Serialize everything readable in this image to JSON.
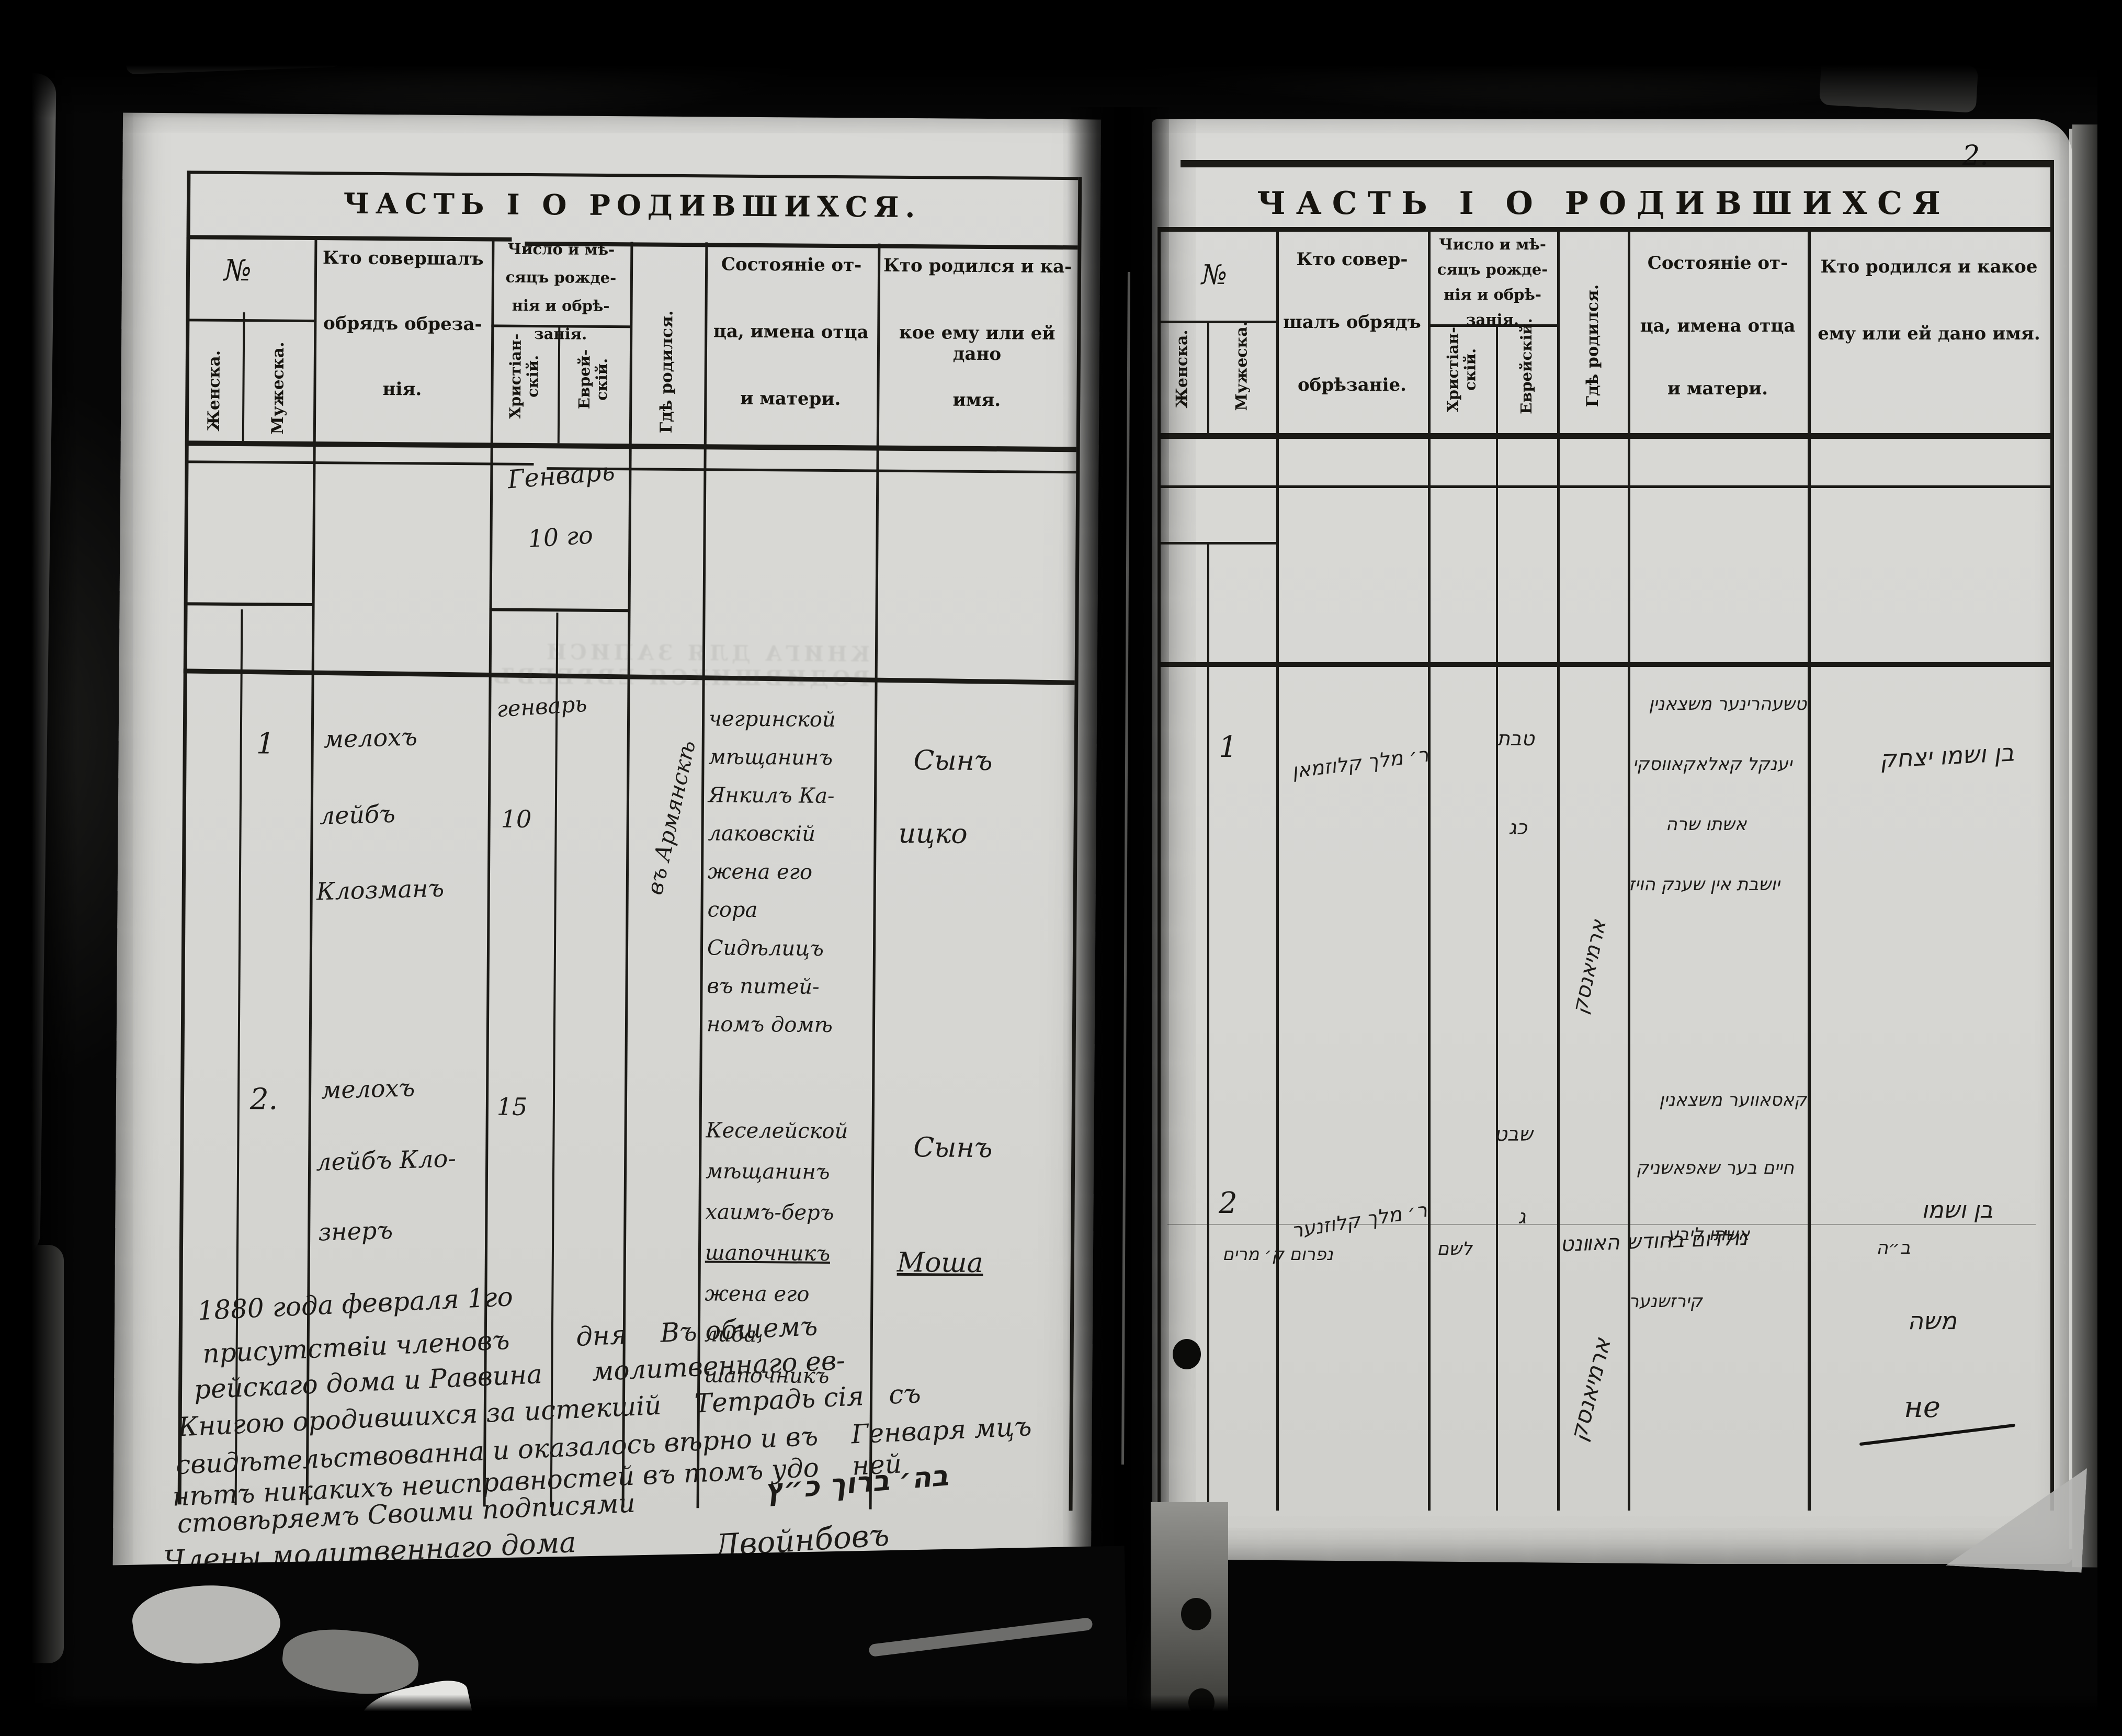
{
  "document": {
    "page_number": "2.",
    "colors": {
      "paper": "#d8d8d4",
      "ink": "#17150f",
      "backdrop": "#060606"
    },
    "left_page": {
      "title": "ЧАСТЬ I О РОДИВШИХСЯ.",
      "columns": {
        "no": "№",
        "female": "Женска.",
        "male": "Мужеска.",
        "performer_lines": [
          "Кто совершалъ",
          "обрядъ обреза-",
          "нія."
        ],
        "date_lines": [
          "Число и мѣ-",
          "сяцъ рожде-",
          "нія и обрѣ-",
          "занія."
        ],
        "christian": "Христіан- скій.",
        "jewish": "Еврей- скій.",
        "where_born": "Гдѣ родился.",
        "father_lines": [
          "Состояніе от-",
          "ца, имена отца",
          "и матери."
        ],
        "who_born_lines": [
          "Кто родился и ка-",
          "кое ему или ей дано",
          "имя."
        ]
      },
      "month_heading": "Генварь",
      "month_heading_day": "10 го",
      "ghost_stamp": "КНИГА ДЛЯ ЗАПИСИ РОДИВШИХСЯ ЕВРЕЕВЪ",
      "entries": [
        {
          "no": "1",
          "performer_lines": [
            "мелохъ",
            "лейбъ",
            "Клозманъ"
          ],
          "month": "генварь",
          "day": "10",
          "where_born": "въ Армянскѣ",
          "father_lines": [
            "чегринской",
            "мѣщанинъ",
            "Янкилъ Ка-",
            "лаковскій",
            "жена его",
            "сора",
            "Сидѣлицъ",
            "въ питей-",
            "номъ домѣ"
          ],
          "child": "Сынъ",
          "child_name": "ицко"
        },
        {
          "no": "2.",
          "performer_lines": [
            "мелохъ",
            "лейбъ Кло-",
            "знеръ"
          ],
          "day": "15",
          "father_lines": [
            "Кеселейской",
            "мѣщанинъ",
            "хаимъ-беръ",
            "шапочникъ",
            "жена его",
            "либа",
            "шапочникъ"
          ],
          "child": "Сынъ",
          "child_name": "Моша"
        }
      ],
      "certification_lines": [
        "1880 года февраля 1го",
        "присутствіи членовъ        дня    Въ общемъ",
        "рейскаго дома и Раввина      молитвеннаго ев-",
        "Книгою ородившихся за истекшій    Тетрадь сія   съ",
        "свидѣтельствованна и оказалось вѣрно и въ    Генваря мцъ",
        "нѣтъ никакихъ неисправностей въ томъ удо    ней",
        "стовѣряемъ Своими подписями",
        "Члены молитвеннаго дома"
      ],
      "signature_hebrew": "בה׳ ברוך כ״ץ",
      "signature_cyrillic": "Двойнбовъ"
    },
    "right_page": {
      "title": "ЧАСТЬ I О РОДИВШИХСЯ",
      "columns": {
        "no": "№",
        "female": "Женска.",
        "male": "Мужеска.",
        "performer_lines": [
          "Кто совер-",
          "шалъ обрядъ",
          "обрѣзаніе."
        ],
        "date_lines": [
          "Число и мѣ-",
          "сяцъ рожде-",
          "нія и обрѣ-",
          "занія."
        ],
        "christian": "Христіан- скій.",
        "jewish": "Еврейскій.",
        "where_born": "Гдѣ родился.",
        "father_lines": [
          "Состояніе от-",
          "ца, имена отца",
          "и матери."
        ],
        "who_born_lines": [
          "Кто родился и какое",
          "ему или ей дано имя."
        ]
      },
      "entries": [
        {
          "no": "1",
          "performer": "ר׳ מלך קלוזמאן",
          "jewish_month": "טבת",
          "jewish_day": "כג",
          "father_lines": [
            "טשעהרינער משצאנין",
            "יענקל קאלאקאווסקי",
            "אשתו שרה",
            "יושבת אין שענק הויז"
          ],
          "child": "בן ושמו יצחק"
        },
        {
          "no": "2",
          "performer": "ר׳ מלך קלוזנער",
          "jewish_month": "שבט",
          "jewish_day": "ג",
          "where_born": "ארמיאנסק",
          "father_lines": [
            "קאסאווער משצאנין",
            "חיים בער שאפאשניק",
            "אשתו ליבע",
            "קירזשנער"
          ],
          "child": "בן ושמו",
          "child_name": "משה"
        }
      ],
      "where_born_diagonal_1": "ארמיאנסק",
      "bottom_line_fragments": [
        "נפרום ק׳ מרים",
        "לשם",
        "נולדום בחודש האװנט",
        "ב״ה"
      ],
      "margin_mark": "не"
    }
  }
}
